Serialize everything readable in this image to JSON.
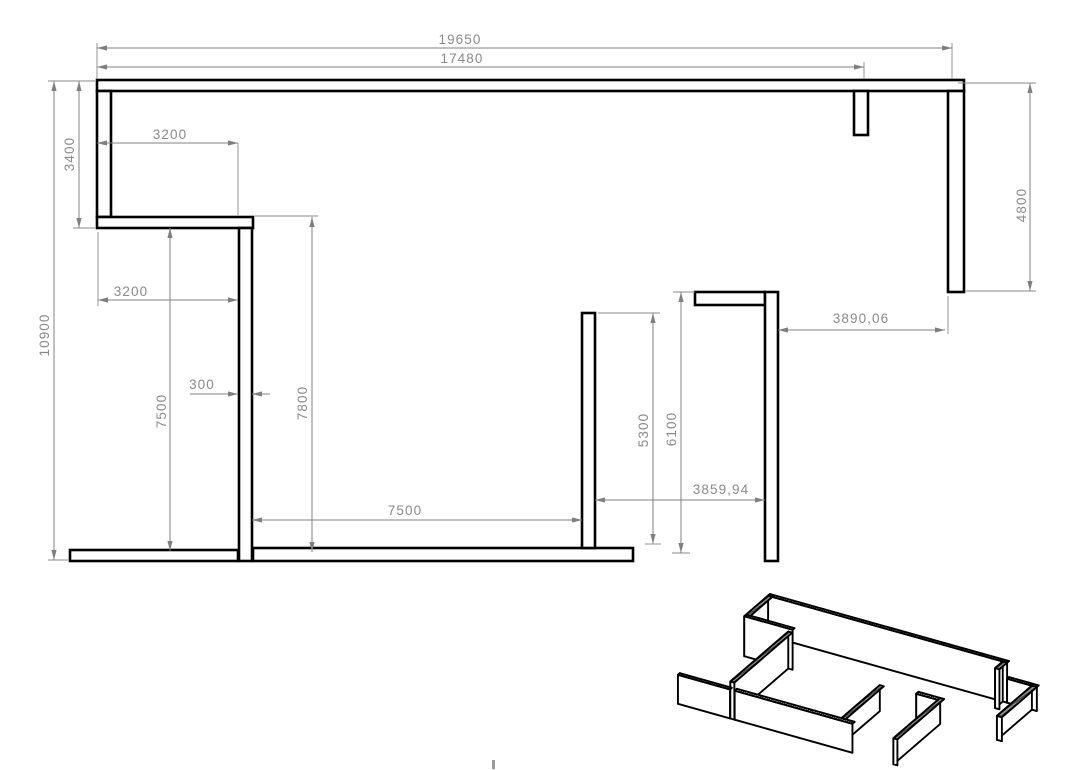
{
  "drawing": {
    "background": "#ffffff",
    "wall_color": "#000000",
    "dim_color": "#828282",
    "plan": {
      "walls": [
        {
          "name": "top-wall",
          "x": 97,
          "y": 80,
          "w": 867,
          "h": 11
        },
        {
          "name": "left-wall",
          "x": 97,
          "y": 91,
          "w": 14,
          "h": 126
        },
        {
          "name": "upper-left-return-wall",
          "x": 97,
          "y": 217,
          "w": 156,
          "h": 11
        },
        {
          "name": "center-partition-wall",
          "x": 239,
          "y": 228,
          "w": 13,
          "h": 333
        },
        {
          "name": "bottom-left-wall",
          "x": 70,
          "y": 550,
          "w": 168,
          "h": 11
        },
        {
          "name": "bottom-center-wall",
          "x": 253,
          "y": 548,
          "w": 380,
          "h": 13
        },
        {
          "name": "mid-partition-wall",
          "x": 582,
          "y": 313,
          "w": 13,
          "h": 235
        },
        {
          "name": "right-return-wall",
          "x": 695,
          "y": 292,
          "w": 70,
          "h": 13
        },
        {
          "name": "right-partition-wall",
          "x": 765,
          "y": 292,
          "w": 13,
          "h": 269
        },
        {
          "name": "top-stub-wall",
          "x": 854,
          "y": 91,
          "w": 14,
          "h": 44
        },
        {
          "name": "right-wall",
          "x": 948,
          "y": 91,
          "w": 16,
          "h": 201
        }
      ],
      "dimensions": [
        {
          "label": "19650",
          "segments": [
            [
              97,
              48,
              952,
              48
            ]
          ],
          "ext": [
            [
              97,
              43,
              97,
              79
            ],
            [
              952,
              43,
              952,
              79
            ]
          ],
          "arrows": [
            [
              97,
              48,
              180
            ],
            [
              952,
              48,
              0
            ]
          ],
          "text": {
            "x": 460,
            "y": 44,
            "rot": false
          }
        },
        {
          "label": "17480",
          "segments": [
            [
              97,
              67,
              864,
              67
            ]
          ],
          "ext": [
            [
              864,
              62,
              864,
              79
            ]
          ],
          "arrows": [
            [
              97,
              67,
              180
            ],
            [
              864,
              67,
              0
            ]
          ],
          "text": {
            "x": 462,
            "y": 63,
            "rot": false
          }
        },
        {
          "label": "3400",
          "segments": [
            [
              79,
              81,
              79,
              228
            ]
          ],
          "ext": [
            [
              73,
              228,
              95,
              228
            ]
          ],
          "arrows": [
            [
              79,
              81,
              270
            ],
            [
              79,
              228,
              90
            ]
          ],
          "text": {
            "x": 74,
            "y": 154,
            "rot": true
          }
        },
        {
          "label": "10900",
          "segments": [
            [
              54,
              81,
              54,
              560
            ]
          ],
          "ext": [
            [
              48,
              81,
              95,
              81
            ],
            [
              48,
              560,
              68,
              560
            ]
          ],
          "arrows": [
            [
              54,
              81,
              270
            ],
            [
              54,
              560,
              90
            ]
          ],
          "text": {
            "x": 49,
            "y": 335,
            "rot": true
          }
        },
        {
          "label": "3200",
          "segments": [
            [
              97,
              143,
              238,
              143
            ]
          ],
          "ext": [
            [
              238,
              143,
              238,
              215
            ]
          ],
          "arrows": [
            [
              97,
              143,
              180
            ],
            [
              238,
              143,
              0
            ]
          ],
          "text": {
            "x": 170,
            "y": 139,
            "rot": false
          }
        },
        {
          "label": "3200",
          "segments": [
            [
              98,
              300,
              238,
              300
            ]
          ],
          "ext": [
            [
              98,
              232,
              98,
              306
            ]
          ],
          "arrows": [
            [
              98,
              300,
              180
            ],
            [
              238,
              300,
              0
            ]
          ],
          "text": {
            "x": 131,
            "y": 296,
            "rot": false
          }
        },
        {
          "label": "300",
          "segments": [
            [
              190,
              394,
              238,
              394
            ],
            [
              252,
              394,
              270,
              394
            ]
          ],
          "ext": [],
          "arrows": [
            [
              238,
              394,
              0
            ],
            [
              252,
              394,
              180
            ]
          ],
          "text": {
            "x": 202,
            "y": 389,
            "rot": false
          }
        },
        {
          "label": "7500",
          "segments": [
            [
              170,
              228,
              170,
              551
            ]
          ],
          "ext": [],
          "arrows": [
            [
              170,
              228,
              270
            ],
            [
              170,
              551,
              90
            ]
          ],
          "text": {
            "x": 166,
            "y": 411,
            "rot": true
          }
        },
        {
          "label": "7800",
          "segments": [
            [
              312,
              217,
              312,
              552
            ]
          ],
          "ext": [
            [
              255,
              216,
              318,
              216
            ]
          ],
          "arrows": [
            [
              312,
              217,
              270
            ],
            [
              312,
              552,
              90
            ]
          ],
          "text": {
            "x": 307,
            "y": 403,
            "rot": true
          }
        },
        {
          "label": "7500",
          "segments": [
            [
              252,
              520,
              582,
              520
            ]
          ],
          "ext": [],
          "arrows": [
            [
              252,
              520,
              180
            ],
            [
              582,
              520,
              0
            ]
          ],
          "text": {
            "x": 405,
            "y": 515,
            "rot": false
          }
        },
        {
          "label": "5300",
          "segments": [
            [
              653,
              313,
              653,
              544
            ]
          ],
          "ext": [
            [
              598,
              313,
              660,
              313
            ],
            [
              645,
              544,
              661,
              544
            ]
          ],
          "arrows": [
            [
              653,
              313,
              270
            ],
            [
              653,
              544,
              90
            ]
          ],
          "text": {
            "x": 648,
            "y": 430,
            "rot": true
          }
        },
        {
          "label": "6100",
          "segments": [
            [
              681,
              292,
              681,
              553
            ]
          ],
          "ext": [
            [
              673,
              292,
              695,
              292
            ],
            [
              672,
              553,
              690,
              553
            ]
          ],
          "arrows": [
            [
              681,
              292,
              270
            ],
            [
              681,
              553,
              90
            ]
          ],
          "text": {
            "x": 676,
            "y": 429,
            "rot": true
          }
        },
        {
          "label": "3859,94",
          "segments": [
            [
              595,
              500,
              765,
              500
            ]
          ],
          "ext": [],
          "arrows": [
            [
              595,
              500,
              180
            ],
            [
              765,
              500,
              0
            ]
          ],
          "text": {
            "x": 721,
            "y": 494,
            "rot": false
          }
        },
        {
          "label": "3890,06",
          "segments": [
            [
              778,
              330,
              945,
              330
            ]
          ],
          "ext": [
            [
              948,
              296,
              948,
              334
            ]
          ],
          "arrows": [
            [
              778,
              330,
              180
            ],
            [
              945,
              330,
              0
            ]
          ],
          "text": {
            "x": 861,
            "y": 323,
            "rot": false
          }
        },
        {
          "label": "4800",
          "segments": [
            [
              1030,
              83,
              1030,
              291
            ]
          ],
          "ext": [
            [
              958,
              83,
              1036,
              83
            ],
            [
              966,
              291,
              1036,
              291
            ]
          ],
          "arrows": [
            [
              1030,
              83,
              270
            ],
            [
              1030,
              291,
              90
            ]
          ],
          "text": {
            "x": 1026,
            "y": 205,
            "rot": true
          }
        }
      ]
    },
    "iso": {
      "origin": [
        770,
        634
      ],
      "ex": [
        0.31,
        0.087
      ],
      "ey": [
        -0.174,
        0.15
      ],
      "base": [
        97,
        80
      ],
      "boxes": [
        {
          "name": "top-wall-main",
          "x1": 97,
          "y1": 80,
          "x2": 868,
          "y2": 91,
          "h": 40
        },
        {
          "name": "top-wall-right",
          "x1": 868,
          "y1": 80,
          "x2": 964,
          "y2": 91,
          "h": 24
        },
        {
          "name": "top-stub-wall",
          "x1": 854,
          "y1": 91,
          "x2": 868,
          "y2": 135,
          "h": 40
        },
        {
          "name": "left-wall",
          "x1": 97,
          "y1": 91,
          "x2": 111,
          "y2": 217,
          "h": 40
        },
        {
          "name": "upper-left-return-wall",
          "x1": 97,
          "y1": 217,
          "x2": 253,
          "y2": 228,
          "h": 40
        },
        {
          "name": "right-wall",
          "x1": 948,
          "y1": 91,
          "x2": 964,
          "y2": 292,
          "h": 24
        },
        {
          "name": "center-partition-wall",
          "x1": 239,
          "y1": 228,
          "x2": 252,
          "y2": 561,
          "h": 37
        },
        {
          "name": "right-return-wall",
          "x1": 695,
          "y1": 292,
          "x2": 765,
          "y2": 305,
          "h": 26
        },
        {
          "name": "right-partition-wall",
          "x1": 765,
          "y1": 292,
          "x2": 778,
          "y2": 561,
          "h": 26
        },
        {
          "name": "mid-partition-wall",
          "x1": 582,
          "y1": 313,
          "x2": 595,
          "y2": 548,
          "h": 26
        },
        {
          "name": "bottom-left-wall",
          "x1": 70,
          "y1": 550,
          "x2": 238,
          "y2": 561,
          "h": 29
        },
        {
          "name": "bottom-center-wall",
          "x1": 253,
          "y1": 548,
          "x2": 633,
          "y2": 561,
          "h": 29
        }
      ]
    },
    "artifact_tick": {
      "x": 492,
      "y": 760,
      "w": 3,
      "h": 9
    }
  }
}
